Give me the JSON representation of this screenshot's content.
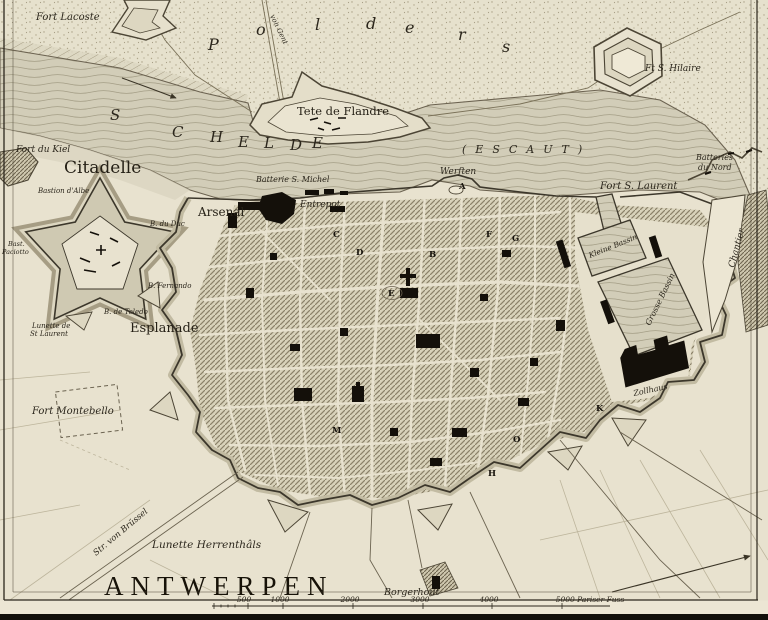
{
  "title": "ANTWERPEN",
  "polders": "Polders",
  "river": {
    "schelde": "SCHELDE",
    "escaut": "(ESCAUT)"
  },
  "roads": {
    "von_gent": "von Gent",
    "str_von_bruessel": "Str. von Brüssel"
  },
  "forts": {
    "lacoste": "Fort Lacoste",
    "hilaire": "Ft S. Hilaire",
    "tete_de_flandre": "Tete de Flandre",
    "du_kiel": "Fort du Kiel",
    "citadelle": "Citadelle",
    "s_laurent": "Fort S. Laurent",
    "montebello": "Fort Montebello",
    "lunette_herrenthals": "Lunette Herrenthâls",
    "lunette_st_laurent_l1": "Lunette de",
    "lunette_st_laurent_l2": "St Laurent",
    "batteries_du_nord_l1": "Batteries",
    "batteries_du_nord_l2": "du Nord"
  },
  "citadel": {
    "bastion_albe": "Bastion d'Albe",
    "b_du_duc": "B. du Duc",
    "b_fernando": "B. Fernando",
    "b_de_toledo": "B. de Toledo",
    "paciotto_l1": "Bast.",
    "paciotto_l2": "Paciotto"
  },
  "city": {
    "arsenal": "Arsenal",
    "entrepot": "Entrepot",
    "batterie_s_michel": "Batterie S. Michel",
    "werften": "Werften",
    "esplanade": "Esplanade",
    "zollhaus": "Zollhaus",
    "kleine_bassin": "Kleine Bassin",
    "grosse_bassin": "Grosse Bassin",
    "chantier": "Chantier",
    "borgerhout": "Borgerhout"
  },
  "block_letters": {
    "a": "A",
    "b": "B",
    "c": "C",
    "d": "D",
    "e": "E",
    "f": "F",
    "g": "G",
    "h": "H",
    "k": "K",
    "m": "M",
    "o": "O"
  },
  "scale": {
    "ticks": [
      "500",
      "1000",
      "2000",
      "3000",
      "4000"
    ],
    "end": "5000 Pariser Fuss"
  },
  "colors": {
    "paper": "#e8e2cf",
    "water": "#d2cdb8",
    "hatch": "#8a8168",
    "ink": "#2b261c",
    "building": "#14100a"
  }
}
